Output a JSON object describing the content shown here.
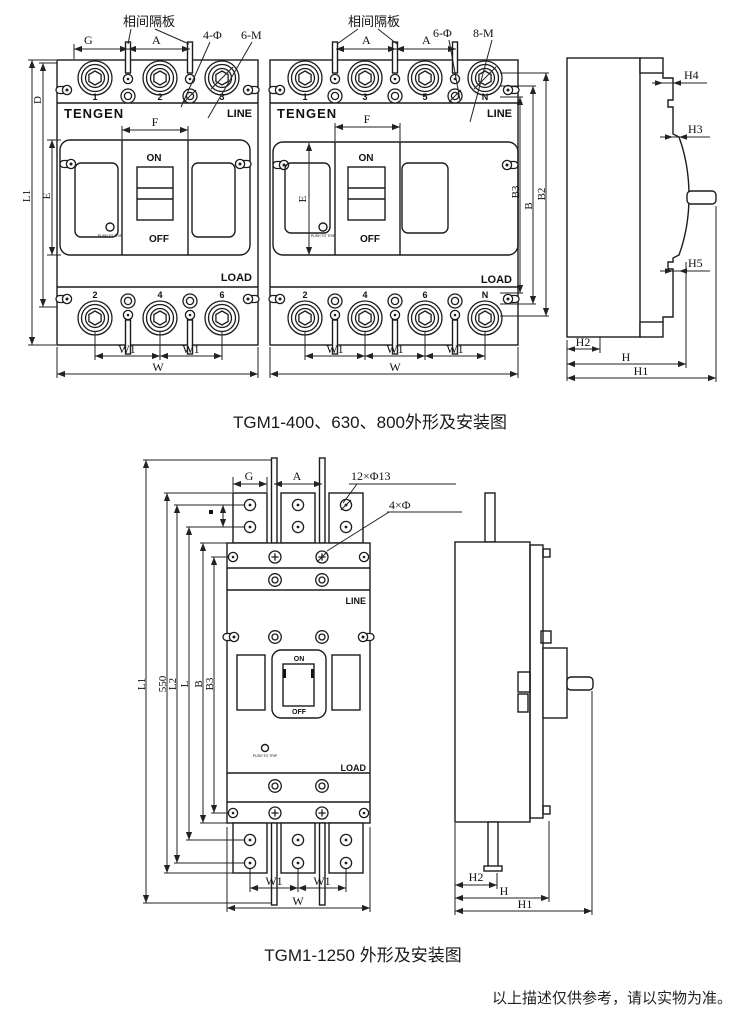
{
  "theme": {
    "ink": "#1c1c1c",
    "paper": "#ffffff"
  },
  "figure1": {
    "caption": "TGM1-400、630、800外形及安装图",
    "labels": {
      "separator": "相间隔板",
      "g": "G",
      "a": "A",
      "d": "D",
      "e": "E",
      "f": "F",
      "l1": "L1",
      "phi4": "4-Φ",
      "m6": "6-M",
      "phi6": "6-Φ",
      "m8": "8-M",
      "b": "B",
      "b2": "B2",
      "b3": "B3",
      "w": "W",
      "w1": "W1",
      "h": "H",
      "h1": "H1",
      "h2": "H2",
      "h3": "H3",
      "h4": "H4",
      "h5": "H5"
    },
    "breaker3p": {
      "brand": "TENGEN",
      "line": "LINE",
      "load": "LOAD",
      "on": "ON",
      "off": "OFF",
      "trip": "PUSH TO TRIP",
      "poles_top": [
        "1",
        "2",
        "3"
      ],
      "poles_bottom": [
        "2",
        "4",
        "6"
      ]
    },
    "breaker4p": {
      "brand": "TENGEN",
      "line": "LINE",
      "load": "LOAD",
      "on": "ON",
      "off": "OFF",
      "trip": "PUSH TO TRIP",
      "poles_top": [
        "1",
        "3",
        "5",
        "N"
      ],
      "poles_bottom": [
        "2",
        "4",
        "6",
        "N"
      ]
    }
  },
  "figure2": {
    "caption": "TGM1-1250 外形及安装图",
    "labels": {
      "g": "G",
      "a": "A",
      "holes12": "12×Φ13",
      "holes4": "4×Φ",
      "l1": "L1",
      "h550": "550",
      "l2": "L2",
      "l": "L",
      "b": "B",
      "b3": "B3",
      "w": "W",
      "w1": "W1",
      "h": "H",
      "h1": "H1",
      "h2": "H2"
    },
    "breaker": {
      "line": "LINE",
      "load": "LOAD",
      "on": "ON",
      "off": "OFF",
      "trip": "PUSH TO TRIP"
    }
  },
  "footnote": "以上描述仅供参考，请以实物为准。"
}
